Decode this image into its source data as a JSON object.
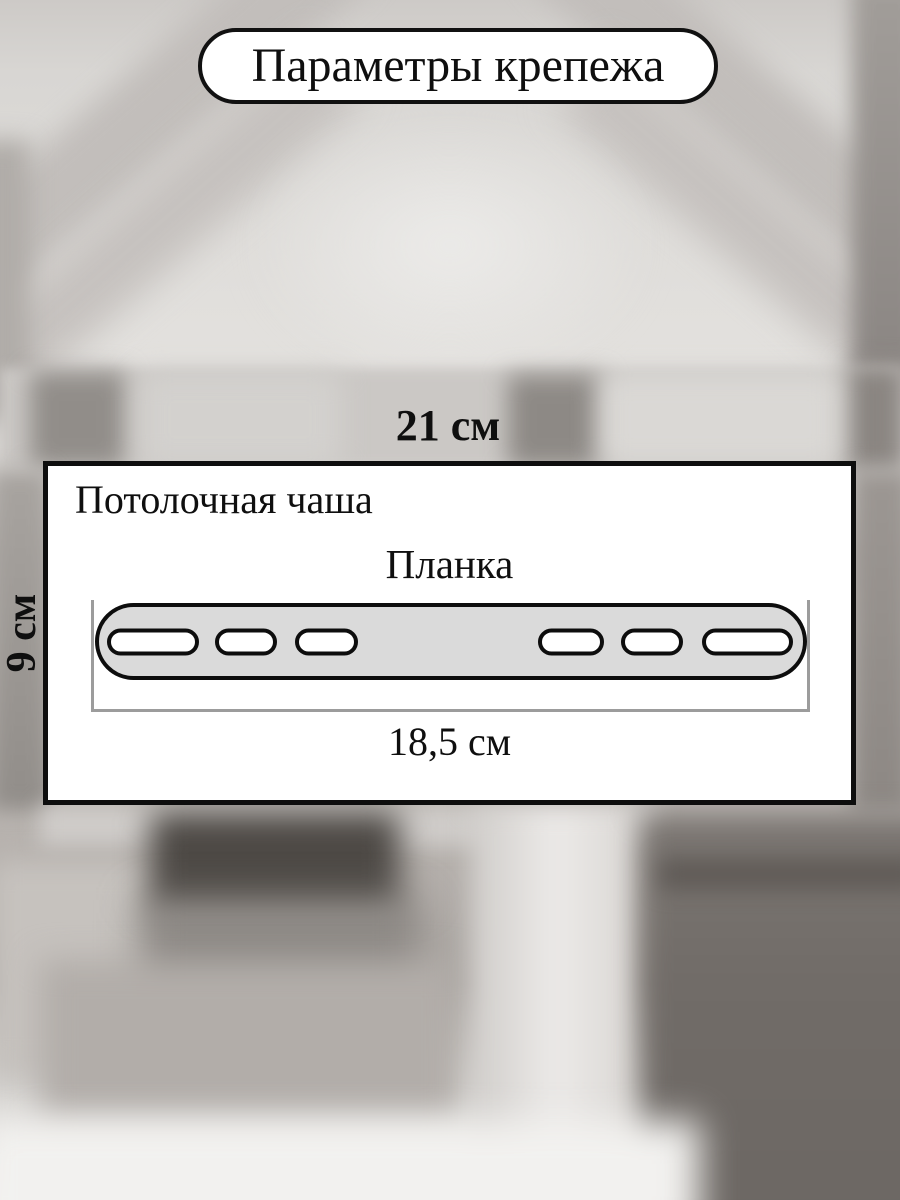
{
  "title": {
    "text": "Параметры крепежа"
  },
  "panel": {
    "title": "Потолочная чаша",
    "bar_label": "Планка",
    "bar_length_label": "18,5 см"
  },
  "dimensions": {
    "width_label": "21 см",
    "height_label": "9 см"
  },
  "bar": {
    "fill": "#dadada",
    "outline": "#0d0d0d",
    "bracket_color": "#9c9c9c",
    "holes": [
      {
        "left": 8,
        "width": 92
      },
      {
        "left": 116,
        "width": 62
      },
      {
        "left": 196,
        "width": 63
      },
      {
        "left": 439,
        "width": 66
      },
      {
        "left": 522,
        "width": 62
      },
      {
        "left": 603,
        "width": 91
      }
    ]
  }
}
